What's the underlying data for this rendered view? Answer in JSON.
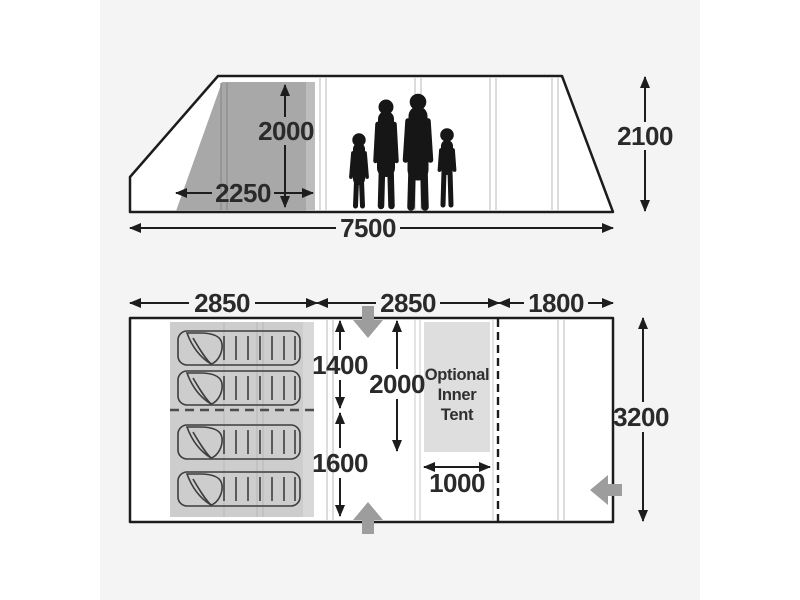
{
  "diagram": {
    "side_view": {
      "bedroom_height": "2000",
      "bedroom_depth": "2250",
      "peak_height": "2100",
      "total_length": "7500"
    },
    "floor_plan": {
      "front_section_length": "2850",
      "middle_section_length": "2850",
      "rear_section_length": "1800",
      "tent_width": "3200",
      "bedroom_front_width": "1400",
      "bedroom_rear_width": "1600",
      "living_area_depth": "2000",
      "inner_tent_width": "1000",
      "inner_tent": {
        "line1": "Optional",
        "line2": "Inner",
        "line3": "Tent"
      }
    },
    "colors": {
      "outline": "#1c1c1c",
      "label_text": "#2a2a2a",
      "side_shaded_area": "#a8a8a8",
      "plan_shaded_area": "#cdcdcd",
      "inner_tent_fill": "#dedede",
      "entrance_arrow": "#9d9d9d",
      "panel_background": "#f4f4f4",
      "page_background": "#ffffff"
    }
  }
}
